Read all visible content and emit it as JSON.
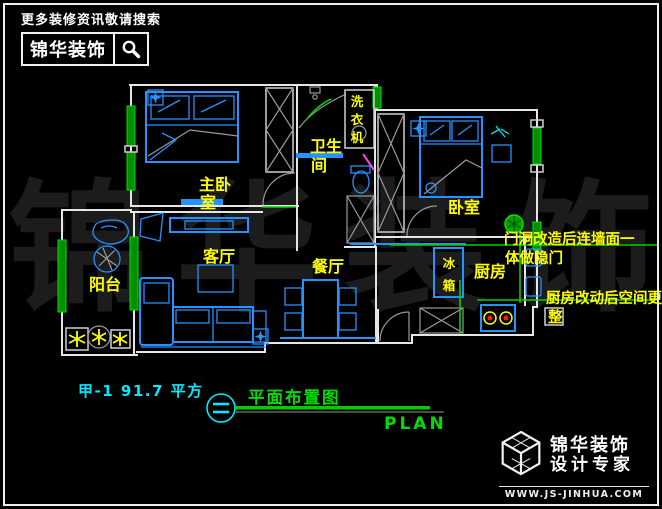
{
  "colors": {
    "furniture_blue": "#2492ff",
    "label_yellow": "#ffff00",
    "window_green": "#00e000",
    "title_cyan": "#00eaff",
    "plan_green": "#00dd00",
    "wall_white": "#e6e6e6"
  },
  "header": {
    "tagline": "更多装修资讯敬请搜索",
    "brand": "锦华装饰"
  },
  "watermark": {
    "text": "锦华装饰"
  },
  "floorplan": {
    "rooms": {
      "master_line1": "主卧",
      "master_line2": "室",
      "bath_line1": "卫生",
      "bath_line2": "间",
      "bedroom": "卧室",
      "living": "客厅",
      "dining": "餐厅",
      "kitchen": "厨房",
      "balcony": "阳台"
    },
    "labels": {
      "washer_chars": [
        "洗",
        "衣",
        "机"
      ],
      "fridge_chars": [
        "冰",
        "箱"
      ]
    },
    "annotations": {
      "door_note_line1": "门洞改造后连墙面一",
      "door_note_line2": "体做隐门",
      "kitchen_note_line1": "厨房改动后空间更",
      "kitchen_note_line2": "整"
    }
  },
  "titleblock": {
    "unit_area": "甲-1  91.7 平方",
    "plan_title": "平面布置图",
    "plan_en": "PLAN"
  },
  "footer": {
    "brand": "锦华装饰",
    "tagline": "设计专家",
    "website": "WWW.JS-JINHUA.COM"
  }
}
